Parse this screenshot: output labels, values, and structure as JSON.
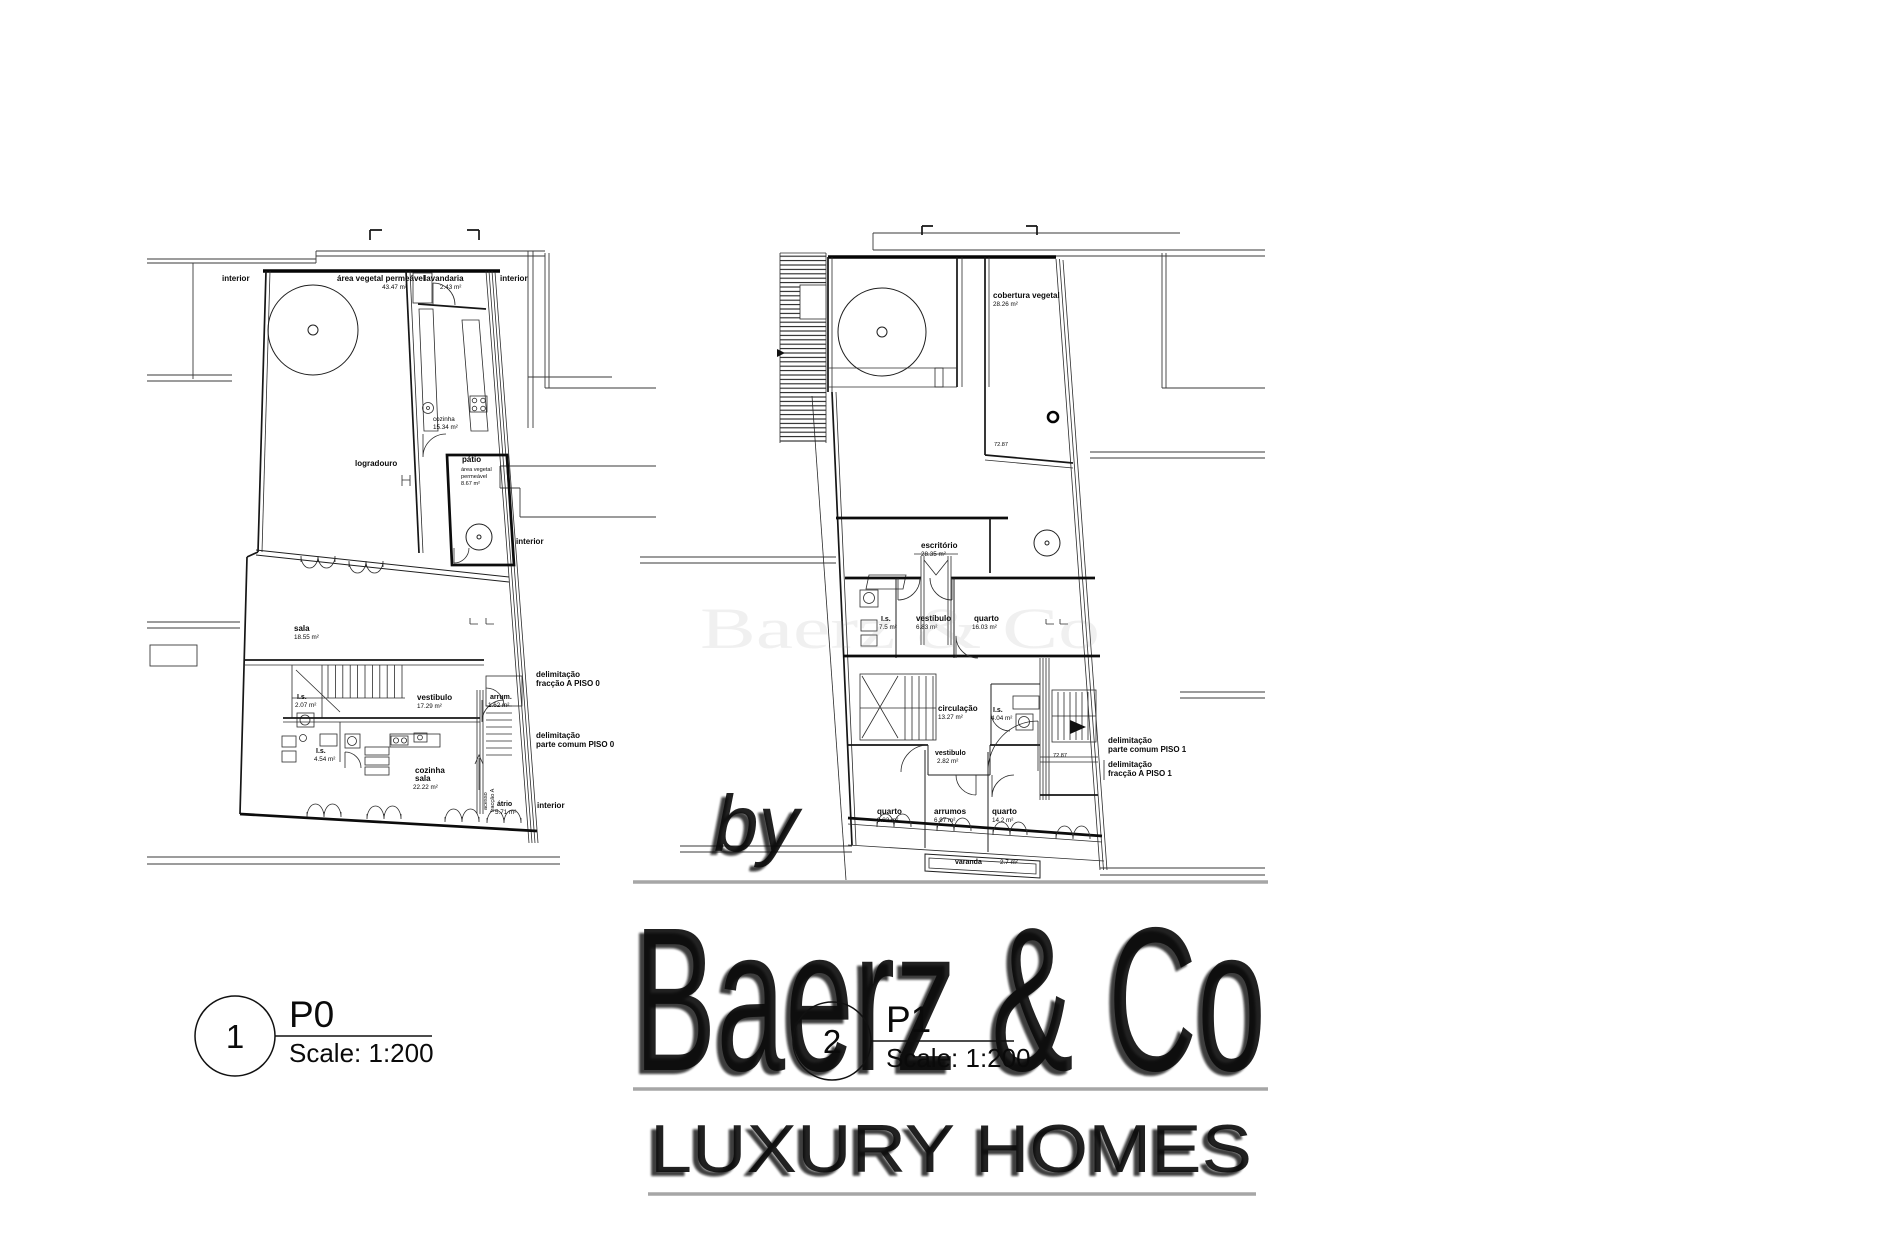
{
  "watermark": {
    "by": "by",
    "brand": "Baerz & Co",
    "tagline": "LUXURY HOMES",
    "accent_gray": "#a6a6a6"
  },
  "markers": [
    {
      "number": "1",
      "code": "P0",
      "scale": "Scale: 1:200"
    },
    {
      "number": "2",
      "code": "P1",
      "scale": "Scale: 1:200"
    }
  ],
  "plans": {
    "p0": {
      "labels": {
        "interior_nw": "interior",
        "area_vegetal": "área vegetal permeável",
        "area_vegetal_val": "43.47 m²",
        "lavandaria": "lavandaria",
        "lavandaria_val": "2.43 m²",
        "interior_ne": "interior",
        "cozinha": "cozinha",
        "cozinha_val": "15.34 m²",
        "logradouro": "logradouro",
        "patio": "pátio",
        "patio_sub1": "área vegetal",
        "patio_sub2": "permeável",
        "patio_val": "8.67 m²",
        "interior_e": "interior",
        "sala": "sala",
        "sala_val": "18.55 m²",
        "vestibulo": "vestibulo",
        "vestibulo_val": "17.29 m²",
        "is1": "I.s.",
        "is1_val": "2.07 m²",
        "arrum": "arrum.",
        "arrum_val": "1.62 m²",
        "is2": "I.s.",
        "is2_val": "4.54 m²",
        "cozinha_sala1": "cozinha",
        "cozinha_sala2": "sala",
        "cozinha_sala_val": "22.22 m²",
        "atrio": "átrio",
        "atrio_val": "5.71 m²",
        "acesso1": "acesso",
        "acesso2": "fracção A",
        "delim1a": "delimitação",
        "delim1b": "fracção A PISO 0",
        "delim2a": "delimitação",
        "delim2b": "parte comum PISO 0",
        "interior_se": "interior"
      }
    },
    "p1": {
      "labels": {
        "cobertura": "cobertura vegetal",
        "cobertura_val": "28.26 m²",
        "elev1": "72.87",
        "escritorio": "escritório",
        "escritorio_val": "28.35 m²",
        "is1": "I.s.",
        "is1_val": "7.5 m²",
        "vestibulo1": "vestíbulo",
        "vestibulo1_val": "6.83 m²",
        "quarto1": "quarto",
        "quarto1_val": "16.03 m²",
        "circulacao": "circulação",
        "circulacao_val": "13.27 m²",
        "is2": "I.s.",
        "is2_val": "4.04 m²",
        "vestibulo2": "vestibulo",
        "vestibulo2_val": "2.82 m²",
        "quarto2": "quarto",
        "quarto2_val": "9.83 m²",
        "arrumos": "arrumos",
        "arrumos_val": "6.97 m²",
        "quarto3": "quarto",
        "quarto3_val": "14.2 m²",
        "varanda": "varanda",
        "varanda_val": "2.7 m²",
        "elev2": "72.87",
        "delim1a": "delimitação",
        "delim1b": "parte comum PISO 1",
        "delim2a": "delimitação",
        "delim2b": "fracção A PISO 1"
      }
    }
  }
}
